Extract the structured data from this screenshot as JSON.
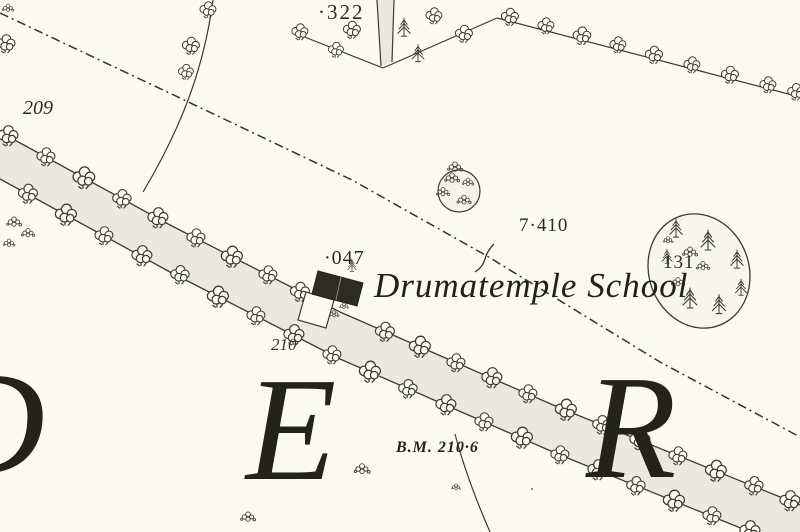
{
  "map": {
    "labels": {
      "spot_height_322": "·322",
      "parcel_209": "209",
      "parcel_047": "·047",
      "school_name": "Drumatemple School",
      "spot_height_7410": "7·410",
      "parcel_131": "131",
      "parcel_210": "210",
      "benchmark": "B.M. 210·6",
      "townland_letter_d": "D",
      "townland_letter_e": "E",
      "townland_letter_r": "R"
    },
    "colors": {
      "paper": "#faf9f3",
      "ink": "#3b3a33",
      "road_fill": "#e9e8e1",
      "building_fill": "#2c2b26"
    }
  }
}
